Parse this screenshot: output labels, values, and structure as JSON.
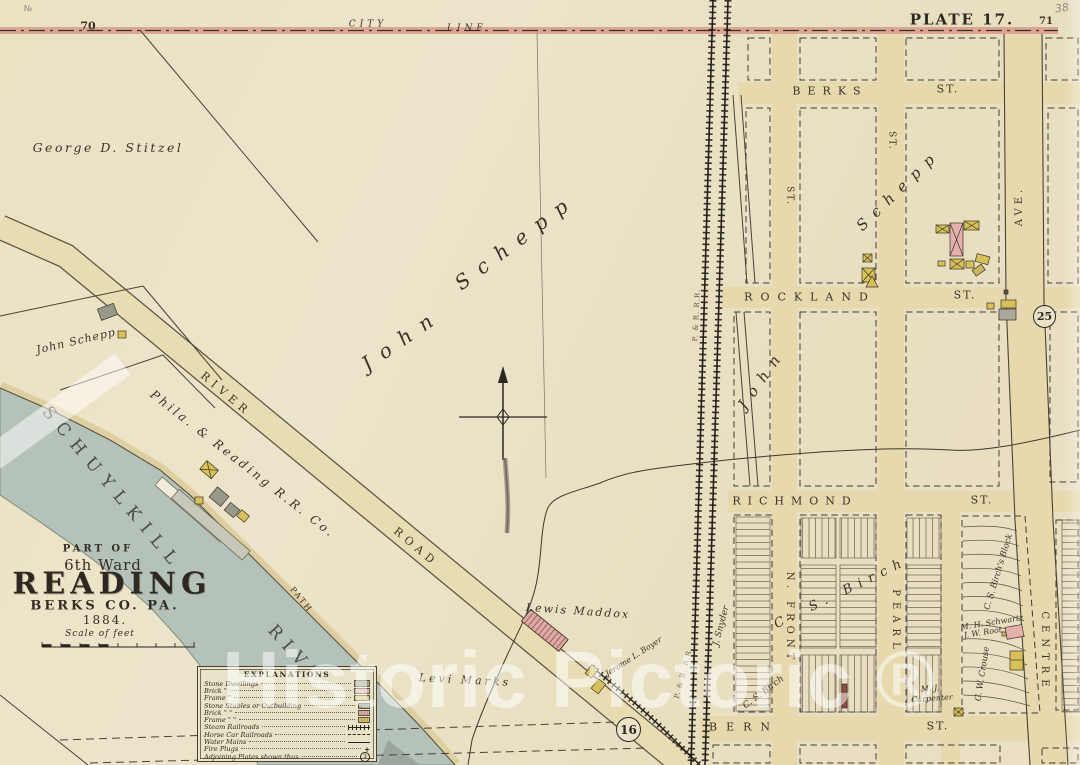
{
  "page": {
    "plate_title": "PLATE 17.",
    "page_number_left": "70",
    "page_number_right": "71",
    "handwritten_number": "38",
    "corner_mark": "№"
  },
  "boundary": {
    "city": "CITY",
    "line": "LINE"
  },
  "cartouche": {
    "part_of": "PART OF",
    "ward": "6th Ward",
    "city": "READING",
    "county": "BERKS CO. PA.",
    "year": "1884.",
    "scale_label": "Scale of feet"
  },
  "streets": {
    "berks": "BERKS",
    "berks_suffix": "ST.",
    "rockland": "ROCKLAND",
    "rockland_suffix": "ST.",
    "richmond": "RICHMOND",
    "richmond_suffix": "ST.",
    "bern": "BERN",
    "bern_suffix": "ST.",
    "n_front": "N. FRONT",
    "pearl": "PEARL",
    "centre": "CENTRE",
    "centre_ave_suffix": "AVE.",
    "front_ext_suffix": "ST.",
    "pearl_ext_suffix": "ST.",
    "river_road_word1": "RIVER",
    "river_road_word2": "ROAD",
    "path": "PATH"
  },
  "water": {
    "name_upper": "SCHUYLKILL",
    "name_lower": "RIVER"
  },
  "railroad": {
    "main": "P. & R. R.R.",
    "branch": "P. & R. R.R."
  },
  "owners": {
    "stitzel": "George D. Stitzel",
    "schepp_large_first": "John",
    "schepp_large_last": "Schepp",
    "schepp_small": "John Schepp",
    "schepp_east_first": "John",
    "schepp_east_last": "Schepp",
    "phila_reading": "Phila. & Reading R.R. Co.",
    "maddox": "Lewis Maddox",
    "marks": "Levi Marks",
    "boyer": "Jerome L. Boyer",
    "snyder": "J. Snyder",
    "birch_small": "C. S. Birch",
    "birch_large": "C. S. Birch",
    "birch_block": "C. S. Birch's Block",
    "crouse": "G. W. Crouse",
    "schwartz": "M. H. Schwartz",
    "root": "J. W. Root",
    "carpenter_line1": "M. J.",
    "carpenter_line2": "Carpenter"
  },
  "plates": {
    "northeast": "25",
    "southwest": "16"
  },
  "explanations": {
    "title": "EXPLANATIONS",
    "rows": [
      {
        "label": "Stone Dwellings",
        "symbol": "stone"
      },
      {
        "label": "Brick \"",
        "symbol": "brick"
      },
      {
        "label": "Frame \"",
        "symbol": "frame"
      },
      {
        "label": "Stone Stables or Outbuilding",
        "symbol": "stone-small"
      },
      {
        "label": "Brick \" \"",
        "symbol": "brick-small"
      },
      {
        "label": "Frame \" \"",
        "symbol": "frame-small"
      },
      {
        "label": "Steam Railroads",
        "symbol": "steam-rail"
      },
      {
        "label": "Horse Car Railroads",
        "symbol": "horse-rail"
      },
      {
        "label": "Water Mains",
        "symbol": "water-main"
      },
      {
        "label": "Fire Plugs",
        "symbol": "fire-plug"
      },
      {
        "label": "Adjoining Plates shown thus",
        "symbol": "plate-circle"
      }
    ],
    "plate_number": "3",
    "fire_plug_glyph": "+"
  },
  "watermark": {
    "text": "Historic Pictoric ®"
  },
  "colors": {
    "paper": "#ebe2c6",
    "street": "#e7d9ad",
    "river": "#b5c2b9",
    "city_line_band": "#d89b8a",
    "brick": "#e2aba5",
    "frame": "#d7c15d",
    "stone": "#9b9c8d"
  }
}
